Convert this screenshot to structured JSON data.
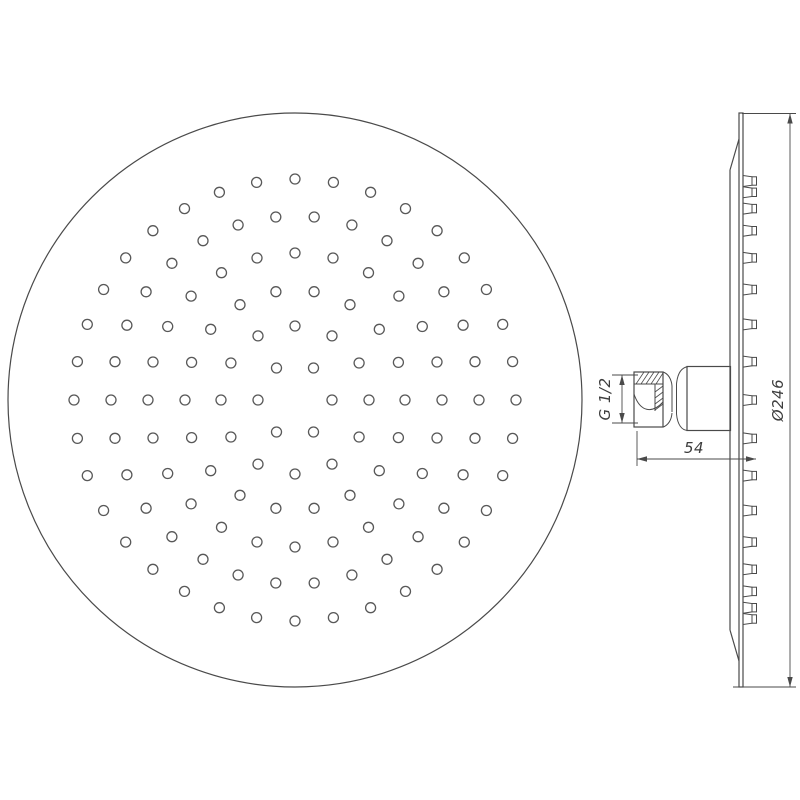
{
  "drawing": {
    "type": "technical-drawing",
    "subject": "overhead shower head, front view and side profile view"
  },
  "front_view": {
    "center": {
      "x": 295,
      "y": 400
    },
    "outer_radius": 287,
    "hole_radius": 5,
    "rings": [
      {
        "radius": 37,
        "count": 6
      },
      {
        "radius": 74,
        "count": 12
      },
      {
        "radius": 110,
        "count": 18
      },
      {
        "radius": 147,
        "count": 24
      },
      {
        "radius": 184,
        "count": 30
      },
      {
        "radius": 221,
        "count": 36
      }
    ]
  },
  "side_view": {
    "center_y": 400,
    "plate_x": 743,
    "nozzle_offsets": [
      0,
      38.4,
      75.6,
      110.5,
      142.1,
      169.3,
      191.4,
      207.7,
      219
    ]
  },
  "dimensions": {
    "thread": {
      "label": "G 1/2"
    },
    "depth": {
      "label": "54"
    },
    "diameter": {
      "label": "Ø246"
    }
  },
  "colors": {
    "line": "#4a4a4a",
    "hole_stroke": "#585858",
    "background": "#ffffff"
  }
}
